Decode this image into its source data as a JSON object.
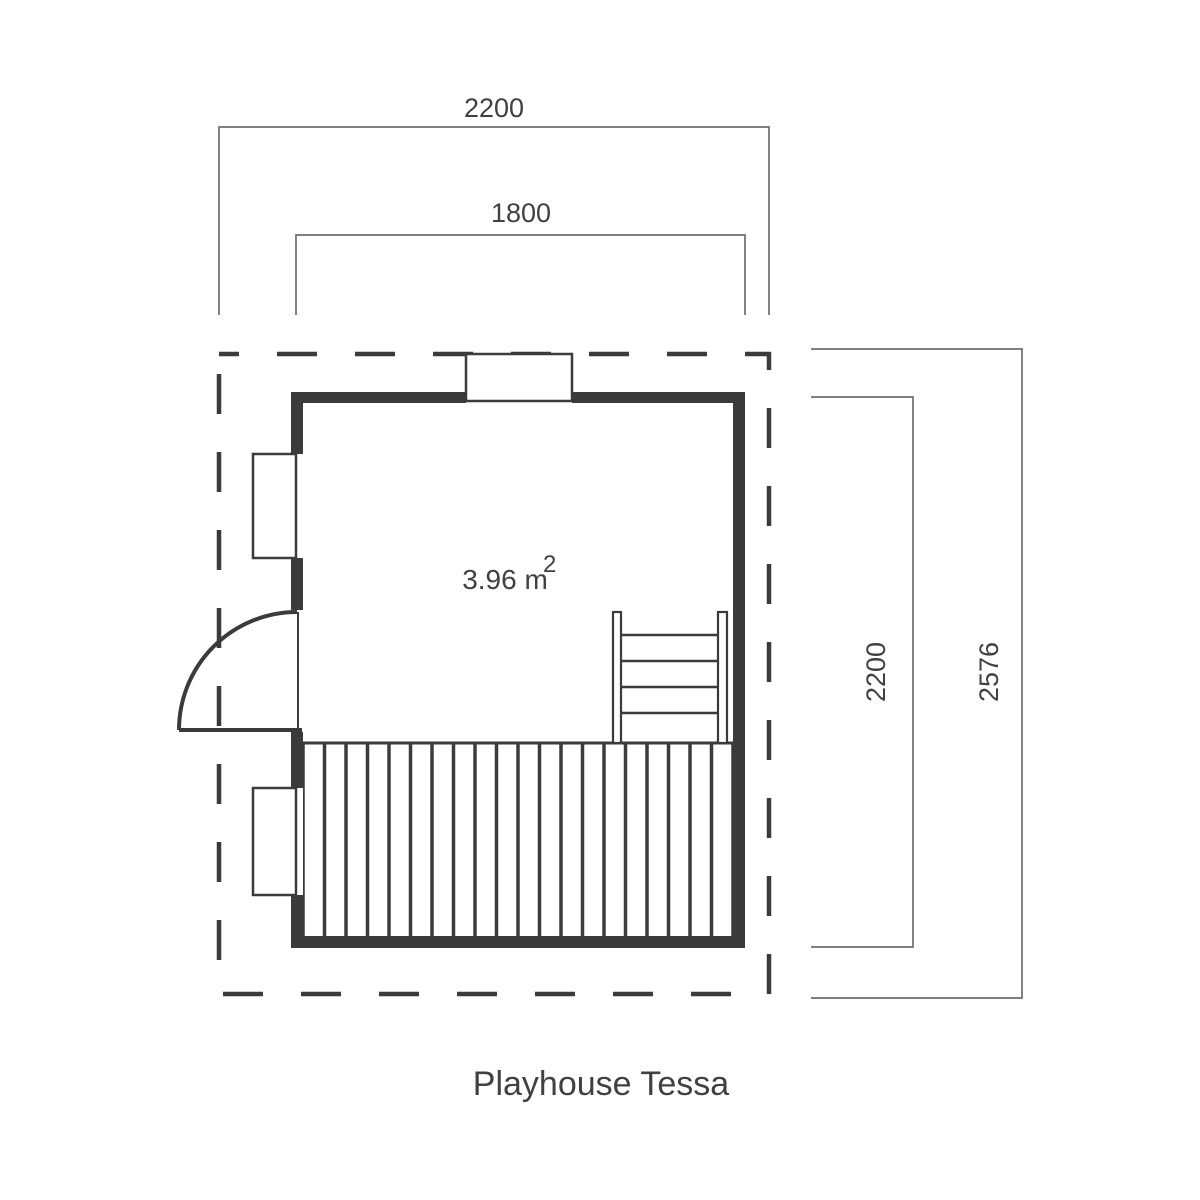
{
  "title": "Playhouse Tessa",
  "area_label": {
    "value": "3.96 m",
    "superscript": "2"
  },
  "dimensions": {
    "roof_width": "2200",
    "interior_width": "1800",
    "wall_depth": "2200",
    "roof_depth": "2576"
  },
  "colors": {
    "line": "#3b3b3d",
    "dimension_line": "#6e6e6e",
    "label_text": "#414143"
  }
}
